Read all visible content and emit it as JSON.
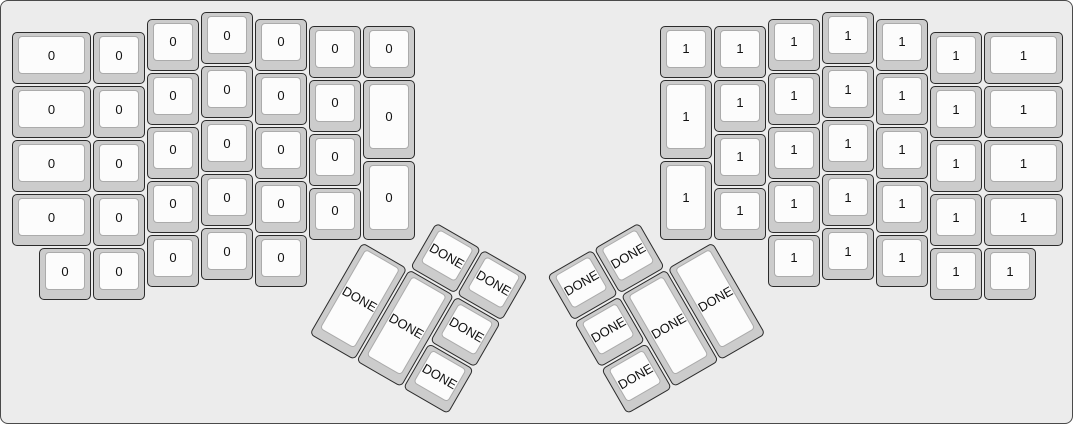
{
  "colors": {
    "canvas_bg": "#ececec",
    "canvas_border": "#4a4a4a",
    "key_base": "#cccccc",
    "key_border": "#2b2b2b",
    "key_top": "#fcfcfc",
    "key_top_border": "#ababab",
    "label_color": "#111111"
  },
  "keyboard": {
    "unit_px": 54,
    "margin_px": 10,
    "groups": [
      {
        "name": "left-main",
        "rotation_deg": 0,
        "keys": [
          {
            "x": 0,
            "y": 0.375,
            "w": 1.5,
            "label": "0"
          },
          {
            "x": 0,
            "y": 1.375,
            "w": 1.5,
            "label": "0"
          },
          {
            "x": 0,
            "y": 2.375,
            "w": 1.5,
            "label": "0"
          },
          {
            "x": 0,
            "y": 3.375,
            "w": 1.5,
            "label": "0"
          },
          {
            "x": 1.5,
            "y": 0.375,
            "label": "0"
          },
          {
            "x": 1.5,
            "y": 1.375,
            "label": "0"
          },
          {
            "x": 1.5,
            "y": 2.375,
            "label": "0"
          },
          {
            "x": 1.5,
            "y": 3.375,
            "label": "0"
          },
          {
            "x": 2.5,
            "y": 0.125,
            "label": "0"
          },
          {
            "x": 2.5,
            "y": 1.125,
            "label": "0"
          },
          {
            "x": 2.5,
            "y": 2.125,
            "label": "0"
          },
          {
            "x": 2.5,
            "y": 3.125,
            "label": "0"
          },
          {
            "x": 2.5,
            "y": 4.125,
            "label": "0"
          },
          {
            "x": 3.5,
            "y": 0,
            "label": "0"
          },
          {
            "x": 3.5,
            "y": 1,
            "label": "0"
          },
          {
            "x": 3.5,
            "y": 2,
            "label": "0"
          },
          {
            "x": 3.5,
            "y": 3,
            "label": "0"
          },
          {
            "x": 3.5,
            "y": 4,
            "label": "0"
          },
          {
            "x": 4.5,
            "y": 0.125,
            "label": "0"
          },
          {
            "x": 4.5,
            "y": 1.125,
            "label": "0"
          },
          {
            "x": 4.5,
            "y": 2.125,
            "label": "0"
          },
          {
            "x": 4.5,
            "y": 3.125,
            "label": "0"
          },
          {
            "x": 4.5,
            "y": 4.125,
            "label": "0"
          },
          {
            "x": 5.5,
            "y": 0.25,
            "label": "0"
          },
          {
            "x": 5.5,
            "y": 1.25,
            "label": "0"
          },
          {
            "x": 5.5,
            "y": 2.25,
            "label": "0"
          },
          {
            "x": 5.5,
            "y": 3.25,
            "label": "0"
          },
          {
            "x": 6.5,
            "y": 0.25,
            "label": "0"
          },
          {
            "x": 6.5,
            "y": 1.25,
            "h": 1.5,
            "label": "0"
          },
          {
            "x": 6.5,
            "y": 2.75,
            "h": 1.5,
            "label": "0"
          },
          {
            "x": 0.5,
            "y": 4.375,
            "label": "0"
          },
          {
            "x": 1.5,
            "y": 4.375,
            "label": "0"
          }
        ]
      },
      {
        "name": "right-main",
        "rotation_deg": 0,
        "keys": [
          {
            "x": 12,
            "y": 0.25,
            "label": "1"
          },
          {
            "x": 12,
            "y": 1.25,
            "h": 1.5,
            "label": "1"
          },
          {
            "x": 12,
            "y": 2.75,
            "h": 1.5,
            "label": "1"
          },
          {
            "x": 13,
            "y": 0.25,
            "label": "1"
          },
          {
            "x": 13,
            "y": 1.25,
            "label": "1"
          },
          {
            "x": 13,
            "y": 2.25,
            "label": "1"
          },
          {
            "x": 13,
            "y": 3.25,
            "label": "1"
          },
          {
            "x": 14,
            "y": 0.125,
            "label": "1"
          },
          {
            "x": 14,
            "y": 1.125,
            "label": "1"
          },
          {
            "x": 14,
            "y": 2.125,
            "label": "1"
          },
          {
            "x": 14,
            "y": 3.125,
            "label": "1"
          },
          {
            "x": 14,
            "y": 4.125,
            "label": "1"
          },
          {
            "x": 15,
            "y": 0,
            "label": "1"
          },
          {
            "x": 15,
            "y": 1,
            "label": "1"
          },
          {
            "x": 15,
            "y": 2,
            "label": "1"
          },
          {
            "x": 15,
            "y": 3,
            "label": "1"
          },
          {
            "x": 15,
            "y": 4,
            "label": "1"
          },
          {
            "x": 16,
            "y": 0.125,
            "label": "1"
          },
          {
            "x": 16,
            "y": 1.125,
            "label": "1"
          },
          {
            "x": 16,
            "y": 2.125,
            "label": "1"
          },
          {
            "x": 16,
            "y": 3.125,
            "label": "1"
          },
          {
            "x": 16,
            "y": 4.125,
            "label": "1"
          },
          {
            "x": 17,
            "y": 0.375,
            "label": "1"
          },
          {
            "x": 17,
            "y": 1.375,
            "label": "1"
          },
          {
            "x": 17,
            "y": 2.375,
            "label": "1"
          },
          {
            "x": 17,
            "y": 3.375,
            "label": "1"
          },
          {
            "x": 17,
            "y": 4.375,
            "label": "1"
          },
          {
            "x": 18,
            "y": 0.375,
            "w": 1.5,
            "label": "1"
          },
          {
            "x": 18,
            "y": 1.375,
            "w": 1.5,
            "label": "1"
          },
          {
            "x": 18,
            "y": 2.375,
            "w": 1.5,
            "label": "1"
          },
          {
            "x": 18,
            "y": 3.375,
            "w": 1.5,
            "label": "1"
          },
          {
            "x": 18,
            "y": 4.375,
            "label": "1"
          }
        ]
      },
      {
        "name": "left-thumb",
        "rotation_deg": 30,
        "pivot_u": {
          "x": 6.5,
          "y": 4.25
        },
        "keys": [
          {
            "x": 1,
            "y": -1,
            "label": "DONE"
          },
          {
            "x": 2,
            "y": -1,
            "label": "DONE"
          },
          {
            "x": 0,
            "y": 0,
            "h": 2,
            "label": "DONE"
          },
          {
            "x": 1,
            "y": 0,
            "h": 2,
            "label": "DONE"
          },
          {
            "x": 2,
            "y": 0,
            "label": "DONE"
          },
          {
            "x": 2,
            "y": 1,
            "label": "DONE"
          }
        ]
      },
      {
        "name": "right-thumb",
        "rotation_deg": -30,
        "pivot_u": {
          "x": 13,
          "y": 4.25
        },
        "keys": [
          {
            "x": -3,
            "y": -1,
            "label": "DONE"
          },
          {
            "x": -2,
            "y": -1,
            "label": "DONE"
          },
          {
            "x": -3,
            "y": 0,
            "label": "DONE"
          },
          {
            "x": -2,
            "y": 0,
            "h": 2,
            "label": "DONE"
          },
          {
            "x": -1,
            "y": 0,
            "h": 2,
            "label": "DONE"
          },
          {
            "x": -3,
            "y": 1,
            "label": "DONE"
          }
        ]
      }
    ]
  }
}
